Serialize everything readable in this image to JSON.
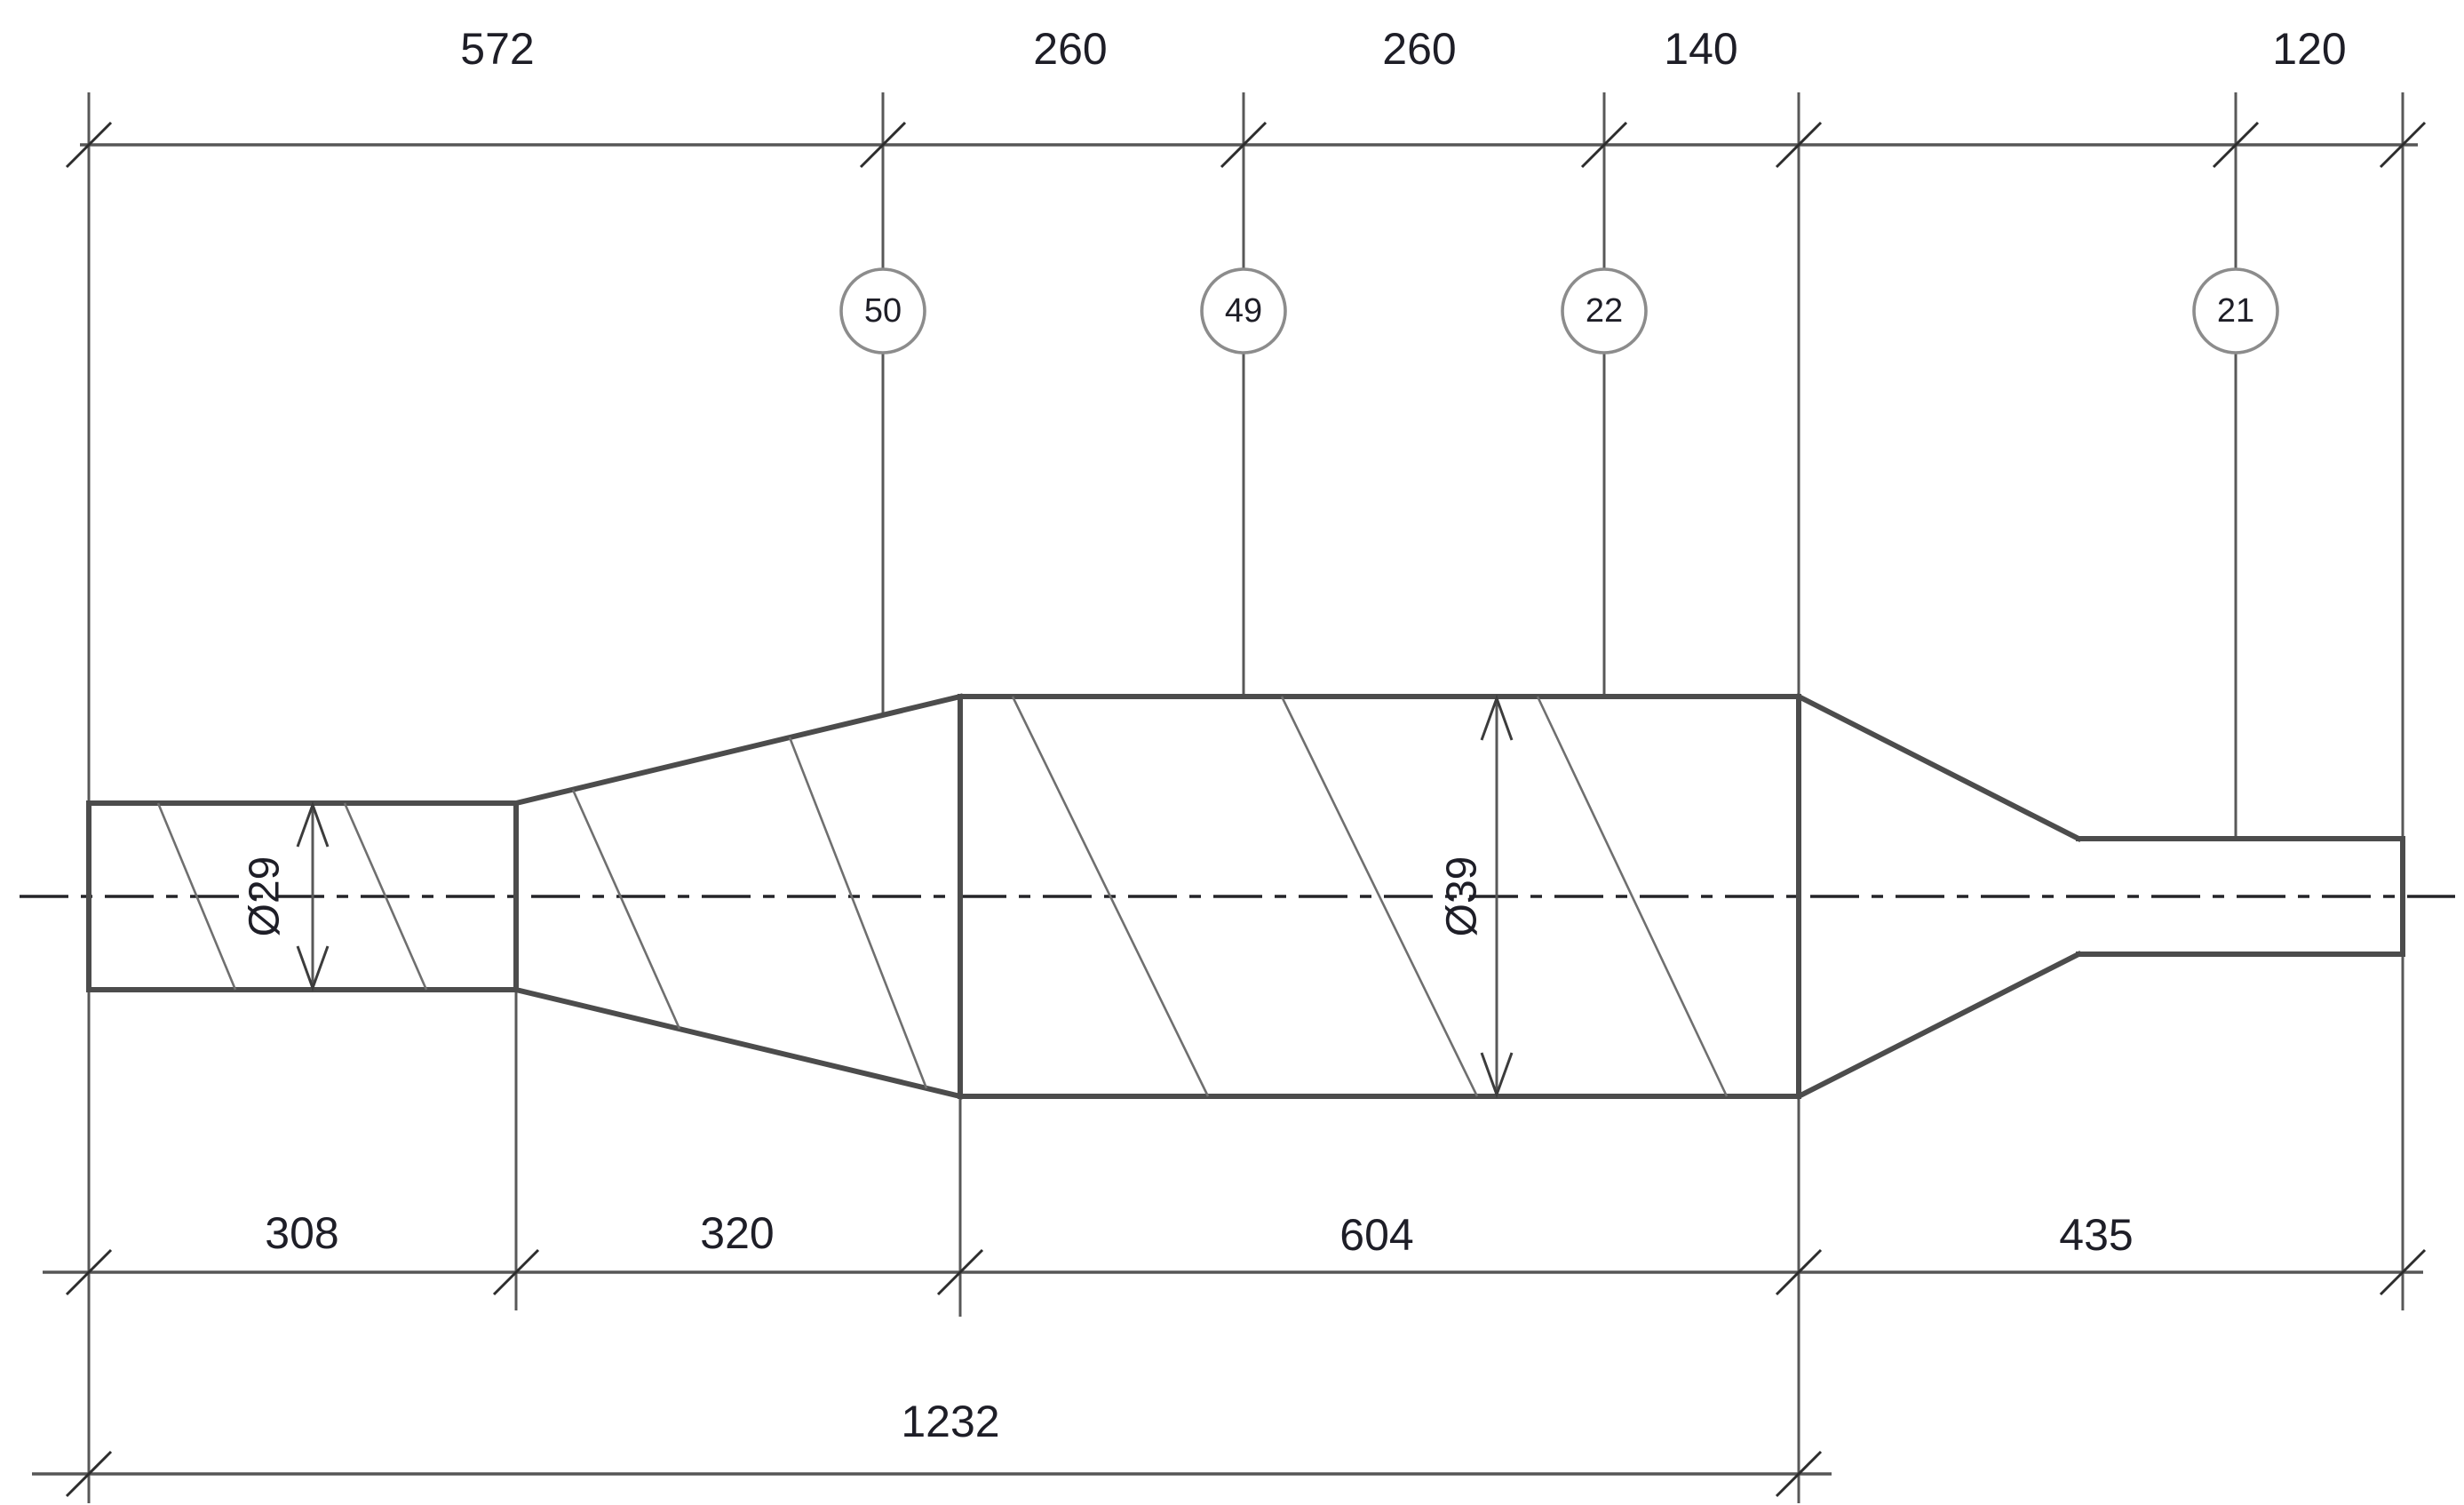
{
  "dims_top": [
    "572",
    "260",
    "260",
    "140",
    "120"
  ],
  "dims_bottom": [
    "308",
    "320",
    "604",
    "435"
  ],
  "dim_overall": "1232",
  "diameters": {
    "small": "Ø29",
    "large": "Ø39"
  },
  "callouts": [
    "50",
    "49",
    "22",
    "21"
  ],
  "colors": {
    "background": "#ffffff",
    "outline": "#4c4c4c",
    "thin_line": "#585858",
    "centerline": "#242428",
    "hatch": "#6f6f6f",
    "callout_circle": "#8c8c8c",
    "text_ink": "#1e1e27"
  }
}
